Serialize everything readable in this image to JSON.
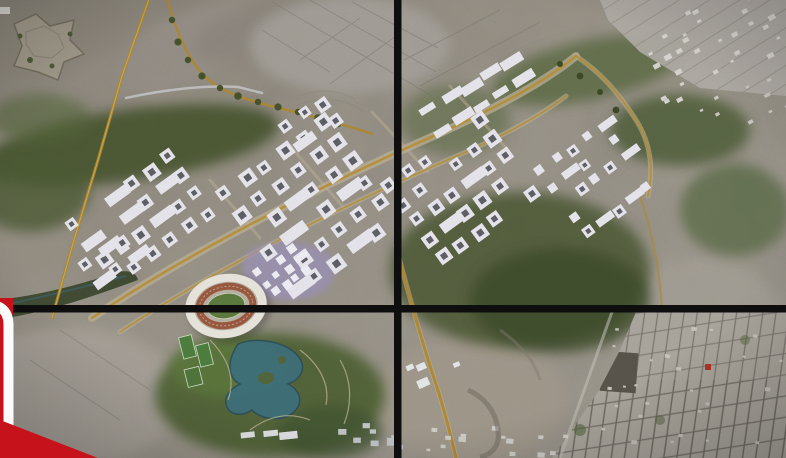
{
  "scene": {
    "description": "Aerial masterplan rendering of a planned city district overlaid on satellite terrain, displayed across a 2x2 video wall with black bezels; a red-and-white news lower-third graphic edge is visible at the bottom-left corner.",
    "kind": "broadcast-frame"
  },
  "video_wall": {
    "bezel_color": "#0e0e0e",
    "vertical_bezel_x": 394,
    "horizontal_bezel_y": 305,
    "bezel_thickness": 8
  },
  "lower_third": {
    "frame_color": "#fbfbfb",
    "ribbon_color": "#c6131b"
  },
  "map": {
    "colors": {
      "terrain": "#9b958b",
      "vegetation": "#47552f",
      "road": "#b4892f",
      "building": "#e9e7ee",
      "courtyard": "#474750",
      "lake": "#3e707c",
      "track": "#9b5a40",
      "plaza": "#9d93bd",
      "city_grid": "#6e6a62"
    },
    "features": [
      "star-fort",
      "orchard-road-loop",
      "diagonal-boulevards",
      "courtyard-housing-blocks",
      "stadium-with-track",
      "artificial-lake",
      "central-park",
      "existing-town-grid",
      "industrial-sheds"
    ]
  },
  "clusters": [
    {
      "name": "west",
      "x": 150,
      "y": 220,
      "rows": 4,
      "cols": 6,
      "cell": 23,
      "size": 12,
      "rot": -36
    },
    {
      "name": "west-south",
      "x": 118,
      "y": 262,
      "rows": 2,
      "cols": 3,
      "cell": 21,
      "size": 11,
      "rot": -36
    },
    {
      "name": "central",
      "x": 318,
      "y": 208,
      "rows": 6,
      "cols": 6,
      "cell": 24,
      "size": 13,
      "rot": -36
    },
    {
      "name": "central-north",
      "x": 318,
      "y": 124,
      "rows": 2,
      "cols": 3,
      "cell": 21,
      "size": 11,
      "rot": -36
    },
    {
      "name": "east-central",
      "x": 468,
      "y": 190,
      "rows": 5,
      "cols": 6,
      "cell": 22,
      "size": 12,
      "rot": -36
    },
    {
      "name": "north-slabs",
      "x": 482,
      "y": 100,
      "rows": 2,
      "cols": 5,
      "cell": 23,
      "size": 11,
      "rot": -32,
      "slab": true
    },
    {
      "name": "far-east",
      "x": 602,
      "y": 180,
      "rows": 5,
      "cols": 5,
      "cell": 19,
      "size": 9,
      "rot": -36
    },
    {
      "name": "stadium-plaza",
      "x": 287,
      "y": 272,
      "rows": 3,
      "cols": 4,
      "cell": 13,
      "size": 7,
      "rot": -36,
      "color": "#f0eff6",
      "plain": true
    },
    {
      "name": "south-terrace",
      "x": 272,
      "y": 441,
      "rows": 1,
      "cols": 3,
      "cell": 19,
      "size": 9,
      "rot": -6,
      "slab": true,
      "color": "#e2e3e7"
    }
  ],
  "specks": [
    {
      "name": "city-north-east",
      "x": 636,
      "y": 2,
      "w": 146,
      "h": 84,
      "count": 30,
      "size": 5,
      "color": "#d8d6d1",
      "rot": -28
    },
    {
      "name": "city-north-east-lower",
      "x": 694,
      "y": 86,
      "w": 88,
      "h": 46,
      "count": 10,
      "size": 4,
      "color": "#ccc9c3",
      "rot": -28
    },
    {
      "name": "village-south",
      "x": 420,
      "y": 426,
      "w": 150,
      "h": 28,
      "count": 14,
      "size": 5,
      "color": "#d2d0ca",
      "rot": 4
    },
    {
      "name": "sheds-south-center",
      "x": 338,
      "y": 414,
      "w": 64,
      "h": 40,
      "count": 8,
      "size": 8,
      "color": "#c3c7c9",
      "rot": 0
    },
    {
      "name": "white-roofs",
      "x": 404,
      "y": 350,
      "w": 52,
      "h": 26,
      "count": 4,
      "size": 9,
      "color": "#e6e8ea",
      "rot": -24
    },
    {
      "name": "city-south-east-roofs",
      "x": 600,
      "y": 320,
      "w": 180,
      "h": 130,
      "count": 26,
      "size": 4,
      "color": "#c9c5bd",
      "rot": 5
    }
  ]
}
